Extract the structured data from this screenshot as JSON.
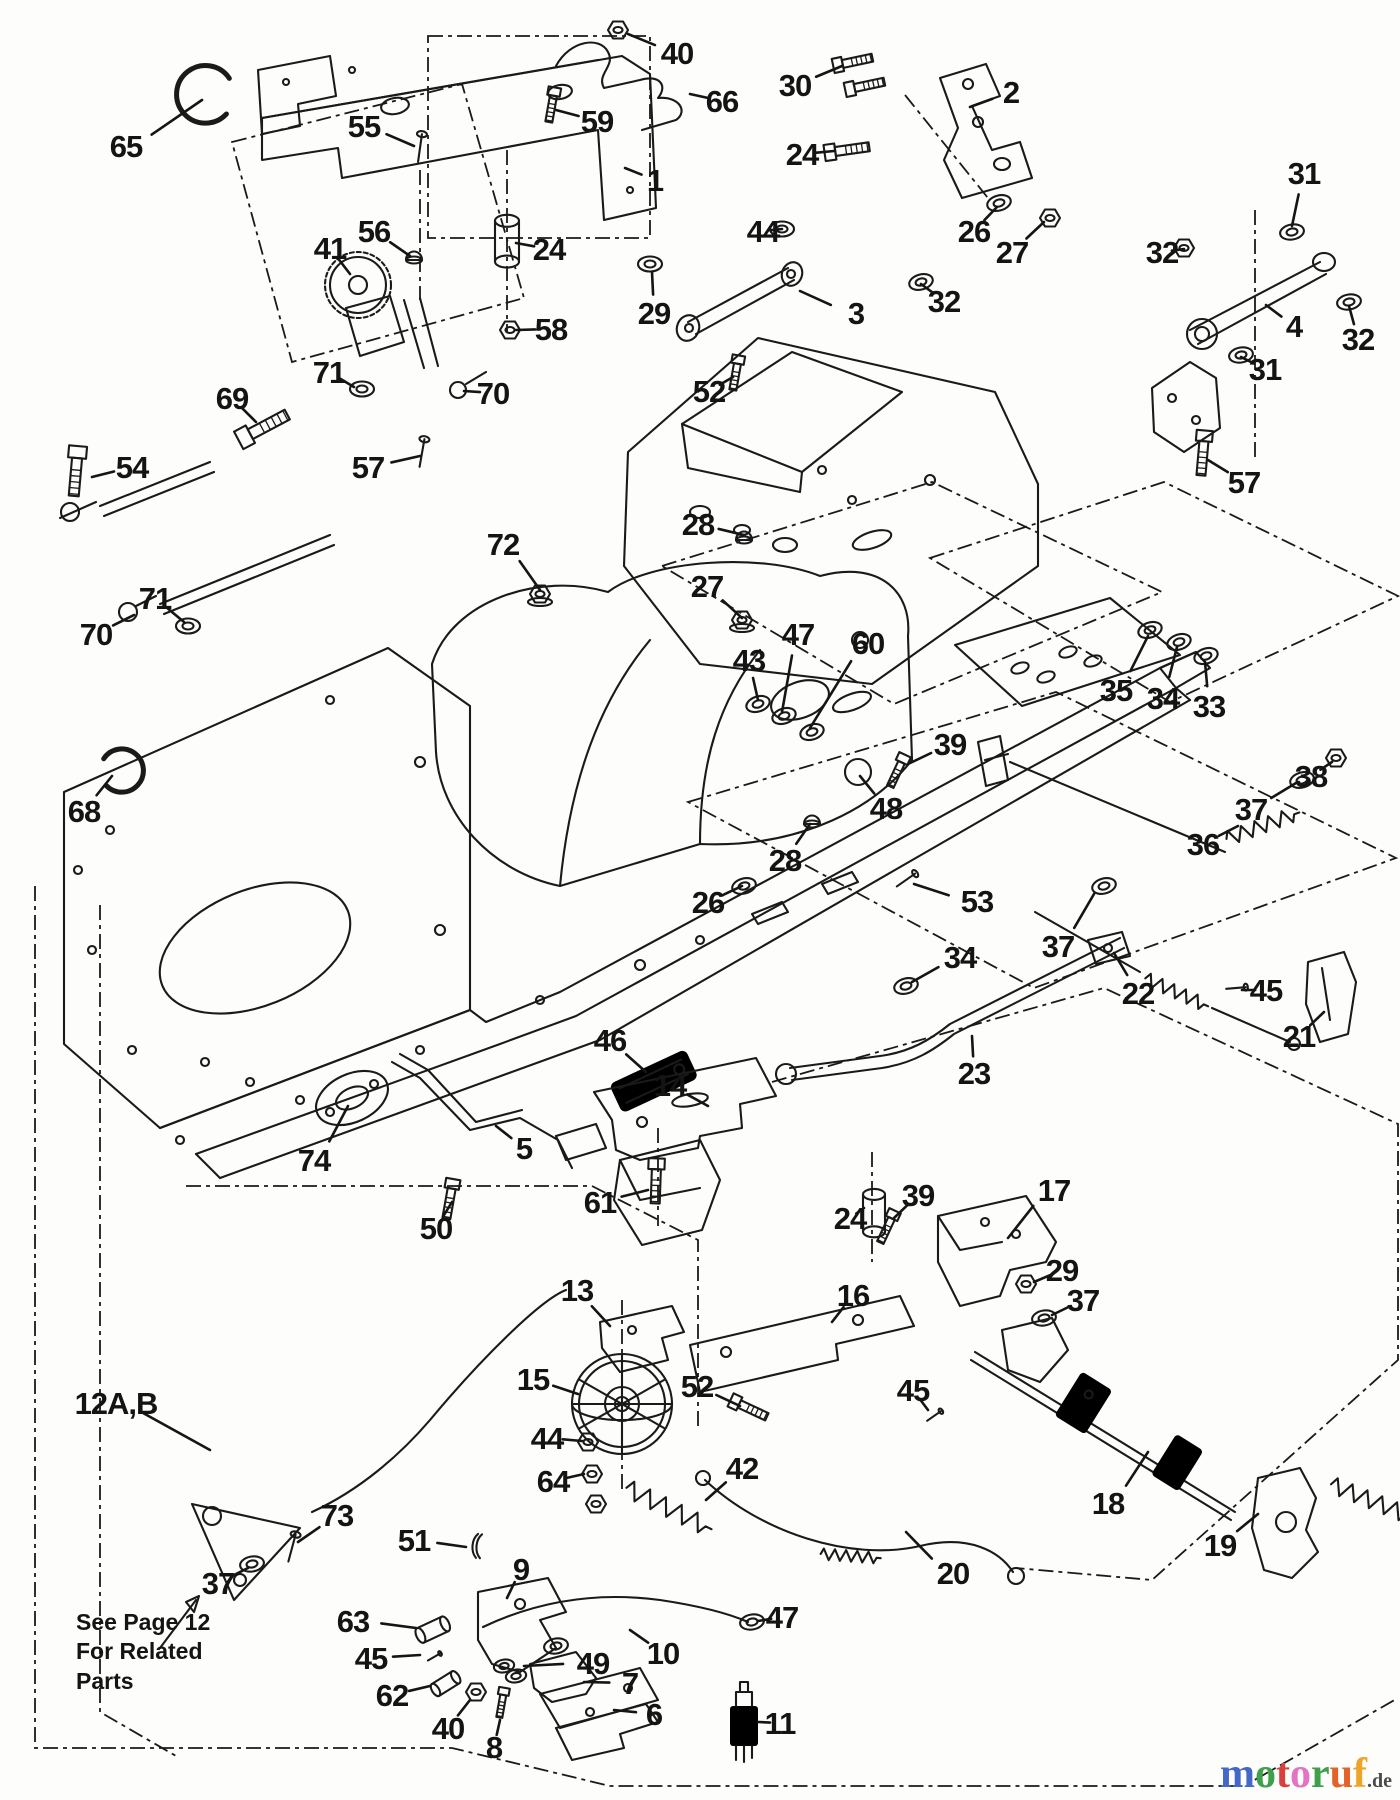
{
  "page": {
    "background": "#fdfdfb",
    "ink": "#1a1a1a"
  },
  "note": {
    "lines": [
      "See Page 12",
      "For Related",
      "Parts"
    ]
  },
  "watermark": {
    "letters": [
      {
        "ch": "m",
        "color": "#4468c8"
      },
      {
        "ch": "o",
        "color": "#3ea04a"
      },
      {
        "ch": "t",
        "color": "#d8403c"
      },
      {
        "ch": "o",
        "color": "#e473c5"
      },
      {
        "ch": "r",
        "color": "#3ea04a"
      },
      {
        "ch": "u",
        "color": "#e2622a"
      },
      {
        "ch": "f",
        "color": "#eda428"
      }
    ],
    "suffix": ".de"
  },
  "callouts": [
    {
      "t": "65",
      "x": 126,
      "y": 146,
      "lx": 202,
      "ly": 100
    },
    {
      "t": "55",
      "x": 364,
      "y": 126,
      "lx": 414,
      "ly": 146
    },
    {
      "t": "59",
      "x": 597,
      "y": 121,
      "lx": 556,
      "ly": 110
    },
    {
      "t": "40",
      "x": 677,
      "y": 53,
      "lx": 628,
      "ly": 34
    },
    {
      "t": "66",
      "x": 722,
      "y": 101,
      "lx": 690,
      "ly": 94
    },
    {
      "t": "1",
      "x": 655,
      "y": 180,
      "lx": 625,
      "ly": 168
    },
    {
      "t": "30",
      "x": 795,
      "y": 85,
      "lx": 842,
      "ly": 66
    },
    {
      "t": "2",
      "x": 1011,
      "y": 92,
      "lx": 970,
      "ly": 107
    },
    {
      "t": "24",
      "x": 802,
      "y": 154,
      "lx": 834,
      "ly": 151
    },
    {
      "t": "26",
      "x": 974,
      "y": 231,
      "lx": 997,
      "ly": 207
    },
    {
      "t": "27",
      "x": 1012,
      "y": 252,
      "lx": 1044,
      "ly": 222
    },
    {
      "t": "44",
      "x": 763,
      "y": 231,
      "lx": 782,
      "ly": 229
    },
    {
      "t": "31",
      "x": 1304,
      "y": 173,
      "lx": 1292,
      "ly": 226
    },
    {
      "t": "32",
      "x": 1162,
      "y": 252,
      "lx": 1184,
      "ly": 249
    },
    {
      "t": "3",
      "x": 856,
      "y": 313,
      "lx": 800,
      "ly": 291
    },
    {
      "t": "32",
      "x": 944,
      "y": 301,
      "lx": 921,
      "ly": 284
    },
    {
      "t": "4",
      "x": 1294,
      "y": 326,
      "lx": 1266,
      "ly": 305
    },
    {
      "t": "32",
      "x": 1358,
      "y": 339,
      "lx": 1349,
      "ly": 306
    },
    {
      "t": "31",
      "x": 1265,
      "y": 369,
      "lx": 1241,
      "ly": 357
    },
    {
      "t": "52",
      "x": 709,
      "y": 391,
      "lx": 733,
      "ly": 377
    },
    {
      "t": "57",
      "x": 1244,
      "y": 482,
      "lx": 1208,
      "ly": 460
    },
    {
      "t": "24",
      "x": 549,
      "y": 249,
      "lx": 516,
      "ly": 243
    },
    {
      "t": "56",
      "x": 374,
      "y": 231,
      "lx": 410,
      "ly": 256
    },
    {
      "t": "41",
      "x": 330,
      "y": 248,
      "lx": 350,
      "ly": 274
    },
    {
      "t": "58",
      "x": 551,
      "y": 329,
      "lx": 516,
      "ly": 330
    },
    {
      "t": "29",
      "x": 654,
      "y": 313,
      "lx": 652,
      "ly": 272
    },
    {
      "t": "71",
      "x": 329,
      "y": 372,
      "lx": 354,
      "ly": 387
    },
    {
      "t": "70",
      "x": 493,
      "y": 393,
      "lx": 464,
      "ly": 391
    },
    {
      "t": "69",
      "x": 232,
      "y": 398,
      "lx": 256,
      "ly": 422
    },
    {
      "t": "54",
      "x": 132,
      "y": 467,
      "lx": 92,
      "ly": 477
    },
    {
      "t": "57",
      "x": 368,
      "y": 467,
      "lx": 420,
      "ly": 456
    },
    {
      "t": "72",
      "x": 503,
      "y": 544,
      "lx": 540,
      "ly": 590
    },
    {
      "t": "68",
      "x": 84,
      "y": 811,
      "lx": 112,
      "ly": 776
    },
    {
      "t": "71",
      "x": 155,
      "y": 598,
      "lx": 184,
      "ly": 622
    },
    {
      "t": "70",
      "x": 96,
      "y": 634,
      "lx": 134,
      "ly": 615
    },
    {
      "t": "28",
      "x": 698,
      "y": 524,
      "lx": 744,
      "ly": 535
    },
    {
      "t": "27",
      "x": 707,
      "y": 586,
      "lx": 742,
      "ly": 618
    },
    {
      "t": "43",
      "x": 749,
      "y": 660,
      "lx": 758,
      "ly": 700
    },
    {
      "t": "47",
      "x": 798,
      "y": 634,
      "lx": 782,
      "ly": 712
    },
    {
      "t": "60",
      "x": 868,
      "y": 643,
      "lx": 810,
      "ly": 728
    },
    {
      "t": "39",
      "x": 950,
      "y": 744,
      "lx": 908,
      "ly": 764
    },
    {
      "t": "48",
      "x": 886,
      "y": 808,
      "lx": 860,
      "ly": 776
    },
    {
      "t": "28",
      "x": 785,
      "y": 860,
      "lx": 810,
      "ly": 824
    },
    {
      "t": "26",
      "x": 708,
      "y": 902,
      "lx": 742,
      "ly": 886
    },
    {
      "t": "35",
      "x": 1116,
      "y": 690,
      "lx": 1148,
      "ly": 636
    },
    {
      "t": "34",
      "x": 1163,
      "y": 698,
      "lx": 1177,
      "ly": 647
    },
    {
      "t": "33",
      "x": 1209,
      "y": 706,
      "lx": 1205,
      "ly": 662
    },
    {
      "t": "38",
      "x": 1311,
      "y": 776,
      "lx": 1332,
      "ly": 762
    },
    {
      "t": "37",
      "x": 1251,
      "y": 809,
      "lx": 1296,
      "ly": 783
    },
    {
      "t": "36",
      "x": 1203,
      "y": 844,
      "lx": 1238,
      "ly": 826
    },
    {
      "t": "53",
      "x": 977,
      "y": 901,
      "lx": 914,
      "ly": 884
    },
    {
      "t": "37",
      "x": 1058,
      "y": 946,
      "lx": 1094,
      "ly": 894
    },
    {
      "t": "34",
      "x": 960,
      "y": 957,
      "lx": 912,
      "ly": 982
    },
    {
      "t": "22",
      "x": 1138,
      "y": 993,
      "lx": 1114,
      "ly": 953
    },
    {
      "t": "45",
      "x": 1266,
      "y": 990,
      "lx": 1242,
      "ly": 990
    },
    {
      "t": "21",
      "x": 1299,
      "y": 1036,
      "lx": 1324,
      "ly": 1012
    },
    {
      "t": "23",
      "x": 974,
      "y": 1073,
      "lx": 972,
      "ly": 1036
    },
    {
      "t": "74",
      "x": 314,
      "y": 1160,
      "lx": 348,
      "ly": 1106
    },
    {
      "t": "5",
      "x": 524,
      "y": 1148,
      "lx": 496,
      "ly": 1126
    },
    {
      "t": "46",
      "x": 610,
      "y": 1040,
      "lx": 646,
      "ly": 1072
    },
    {
      "t": "50",
      "x": 436,
      "y": 1228,
      "lx": 452,
      "ly": 1202
    },
    {
      "t": "61",
      "x": 600,
      "y": 1202,
      "lx": 648,
      "ly": 1190
    },
    {
      "t": "14",
      "x": 670,
      "y": 1085,
      "lx": 708,
      "ly": 1106
    },
    {
      "t": "13",
      "x": 577,
      "y": 1290,
      "lx": 610,
      "ly": 1326
    },
    {
      "t": "24",
      "x": 850,
      "y": 1218,
      "lx": 864,
      "ly": 1208
    },
    {
      "t": "39",
      "x": 918,
      "y": 1195,
      "lx": 894,
      "ly": 1218
    },
    {
      "t": "16",
      "x": 853,
      "y": 1295,
      "lx": 832,
      "ly": 1322
    },
    {
      "t": "17",
      "x": 1054,
      "y": 1190,
      "lx": 1008,
      "ly": 1238
    },
    {
      "t": "29",
      "x": 1062,
      "y": 1270,
      "lx": 1034,
      "ly": 1282
    },
    {
      "t": "37",
      "x": 1083,
      "y": 1300,
      "lx": 1052,
      "ly": 1315
    },
    {
      "t": "45",
      "x": 913,
      "y": 1390,
      "lx": 928,
      "ly": 1410
    },
    {
      "t": "52",
      "x": 697,
      "y": 1386,
      "lx": 740,
      "ly": 1406
    },
    {
      "t": "42",
      "x": 742,
      "y": 1468,
      "lx": 706,
      "ly": 1500
    },
    {
      "t": "15",
      "x": 533,
      "y": 1379,
      "lx": 578,
      "ly": 1394
    },
    {
      "t": "44",
      "x": 547,
      "y": 1438,
      "lx": 582,
      "ly": 1441
    },
    {
      "t": "64",
      "x": 553,
      "y": 1481,
      "lx": 584,
      "ly": 1474
    },
    {
      "t": "12A,B",
      "x": 116,
      "y": 1403,
      "lx": 210,
      "ly": 1450
    },
    {
      "t": "73",
      "x": 337,
      "y": 1515,
      "lx": 298,
      "ly": 1542
    },
    {
      "t": "51",
      "x": 414,
      "y": 1540,
      "lx": 466,
      "ly": 1547
    },
    {
      "t": "37",
      "x": 218,
      "y": 1583,
      "lx": 248,
      "ly": 1568
    },
    {
      "t": "9",
      "x": 521,
      "y": 1569,
      "lx": 507,
      "ly": 1598
    },
    {
      "t": "63",
      "x": 353,
      "y": 1621,
      "lx": 416,
      "ly": 1628
    },
    {
      "t": "45",
      "x": 371,
      "y": 1658,
      "lx": 420,
      "ly": 1655
    },
    {
      "t": "62",
      "x": 392,
      "y": 1695,
      "lx": 430,
      "ly": 1686
    },
    {
      "t": "40",
      "x": 448,
      "y": 1728,
      "lx": 470,
      "ly": 1700
    },
    {
      "t": "8",
      "x": 494,
      "y": 1747,
      "lx": 500,
      "ly": 1720
    },
    {
      "t": "49",
      "x": 593,
      "y": 1663,
      "lx": 524,
      "ly": 1666
    },
    {
      "t": "7",
      "x": 630,
      "y": 1683,
      "lx": 584,
      "ly": 1682
    },
    {
      "t": "6",
      "x": 654,
      "y": 1714,
      "lx": 614,
      "ly": 1710
    },
    {
      "t": "10",
      "x": 663,
      "y": 1653,
      "lx": 630,
      "ly": 1630
    },
    {
      "t": "47",
      "x": 782,
      "y": 1617,
      "lx": 758,
      "ly": 1621
    },
    {
      "t": "11",
      "x": 780,
      "y": 1723,
      "lx": 758,
      "ly": 1722
    },
    {
      "t": "20",
      "x": 953,
      "y": 1573,
      "lx": 906,
      "ly": 1532
    },
    {
      "t": "18",
      "x": 1108,
      "y": 1503,
      "lx": 1148,
      "ly": 1452
    },
    {
      "t": "19",
      "x": 1220,
      "y": 1545,
      "lx": 1258,
      "ly": 1514
    }
  ]
}
